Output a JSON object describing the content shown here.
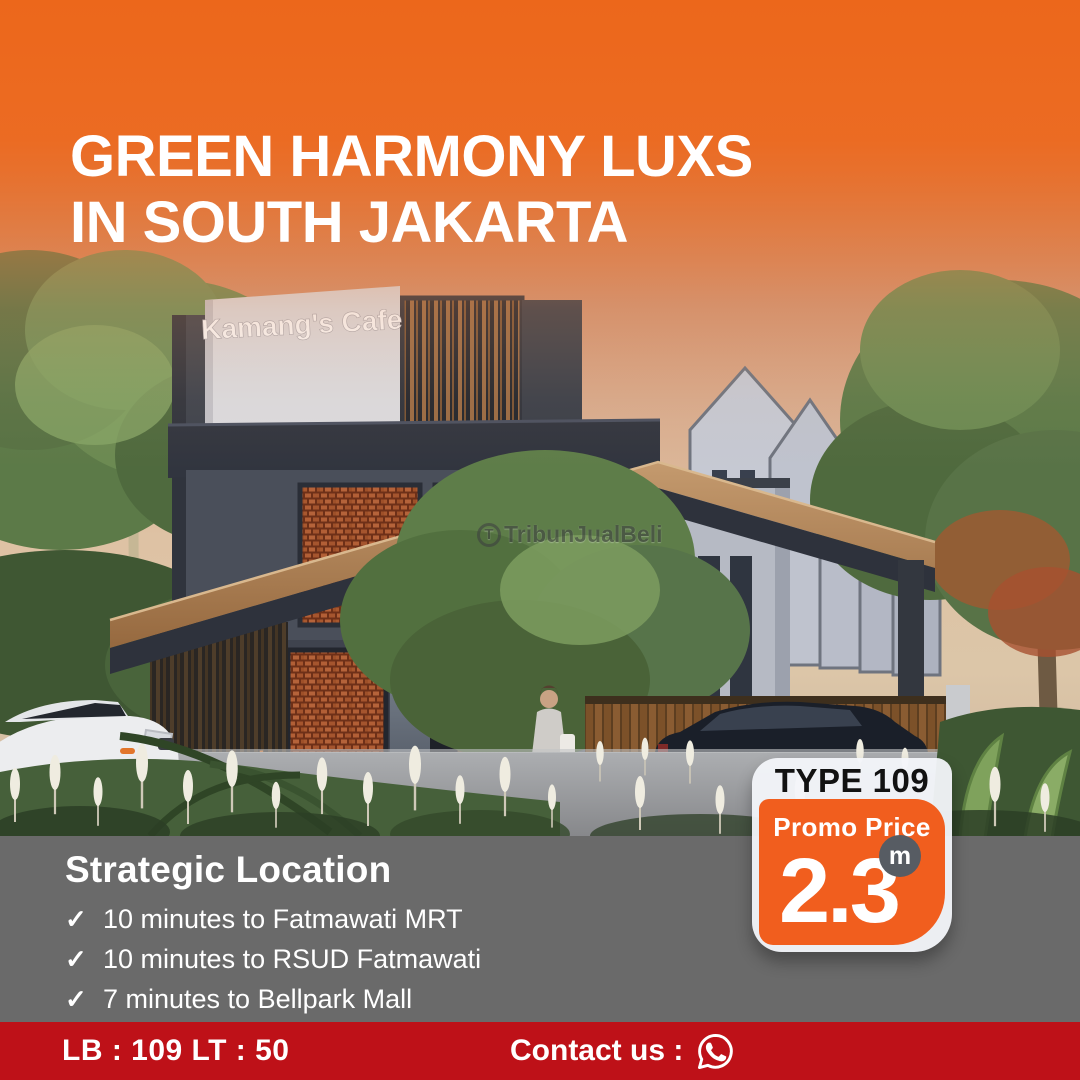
{
  "poster": {
    "title_line1": "GREEN HARMONY LUXS",
    "title_line2": "IN SOUTH JAKARTA"
  },
  "scene": {
    "cafe_sign": "Kamang's Cafe",
    "shop_sign": "Kamang's"
  },
  "watermark": {
    "logo_letter": "T",
    "text": "TribunJualBeli"
  },
  "location": {
    "heading": "Strategic Location",
    "items": [
      {
        "check": "✓",
        "text": "10 minutes to Fatmawati MRT"
      },
      {
        "check": "✓",
        "text": "10 minutes to RSUD Fatmawati"
      },
      {
        "check": "✓",
        "text": "7 minutes to Bellpark Mall"
      }
    ]
  },
  "price_badge": {
    "type_label": "TYPE 109",
    "promo_label": "Promo Price",
    "price_value": "2.3",
    "price_unit": "m"
  },
  "footer": {
    "area_text": "LB : 109 LT : 50",
    "contact_label": "Contact us :",
    "whatsapp_icon": "whatsapp"
  },
  "colors": {
    "top_orange": "#EC671B",
    "badge_orange": "#F15E1E",
    "panel_gray": "#6A6A6A",
    "footer_red": "#BE1118",
    "unit_circle_gray": "#575C63"
  }
}
